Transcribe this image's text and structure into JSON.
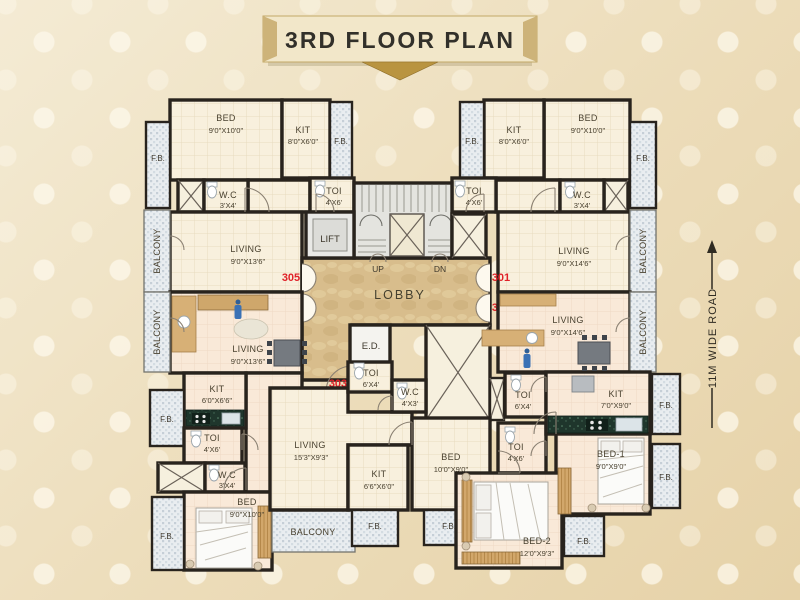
{
  "title": "3RD FLOOR PLAN",
  "road_label": "11M WIDE ROAD",
  "core": {
    "lift": "LIFT",
    "lobby": "LOBBY",
    "up": "UP",
    "dn": "DN",
    "ed": "E.D."
  },
  "unit_numbers": {
    "u301": "301",
    "u302": "302",
    "u303": "303",
    "u304": "304",
    "u305": "305"
  },
  "labels": {
    "fb": "F.B.",
    "balcony": "BALCONY",
    "u305": {
      "bed_n": "BED",
      "bed_d": "9'0\"X10'0\"",
      "kit_n": "KIT",
      "kit_d": "8'0\"X6'0\"",
      "wc_n": "W.C",
      "wc_d": "3'X4'",
      "toi_n": "TOI",
      "toi_d": "4'X6'",
      "liv_n": "LIVING",
      "liv_d": "9'0\"X13'6\""
    },
    "u301": {
      "bed_n": "BED",
      "bed_d": "9'0\"X10'0\"",
      "kit_n": "KIT",
      "kit_d": "8'0\"X6'0\"",
      "wc_n": "W.C",
      "wc_d": "3'X4'",
      "toi_n": "TOI",
      "toi_d": "4'X6'",
      "liv_n": "LIVING",
      "liv_d": "9'0\"X14'6\""
    },
    "u304": {
      "liv_n": "LIVING",
      "liv_d": "9'0\"X13'6\"",
      "kit_n": "KIT",
      "kit_d": "6'0\"X6'6\"",
      "toi_n": "TOI",
      "toi_d": "4'X6'",
      "wc_n": "W.C",
      "wc_d": "3'X4'",
      "bed_n": "BED",
      "bed_d": "9'0\"X10'0\""
    },
    "u303": {
      "liv_n": "LIVING",
      "liv_d": "15'3\"X9'3\"",
      "kit_n": "KIT",
      "kit_d": "6'6\"X6'0\"",
      "toi_n": "TOI",
      "toi_d": "6'X4'",
      "wc_n": "W.C",
      "wc_d": "4'X3'",
      "bed_n": "BED",
      "bed_d": "10'0\"X9'0\""
    },
    "u302": {
      "liv_n": "LIVING",
      "liv_d": "9'0\"X14'6\"",
      "kit_n": "KIT",
      "kit_d": "7'0\"X9'0\"",
      "toi_a_n": "TOI",
      "toi_a_d": "6'X4'",
      "toi_b_n": "TOI",
      "toi_b_d": "4'X6'",
      "bed1_n": "BED-1",
      "bed1_d": "9'0\"X9'0\"",
      "bed2_n": "BED-2",
      "bed2_d": "12'0\"X9'3\""
    }
  },
  "colors": {
    "accent_red": "#e02128",
    "wall": "#28231d",
    "lobby_marble": "#d8bd8c",
    "hatch": "#e9edf0",
    "floor_cream": "#f8f0dd",
    "floor_pink": "#f9e9d8",
    "counter_green": "#1f362c"
  }
}
